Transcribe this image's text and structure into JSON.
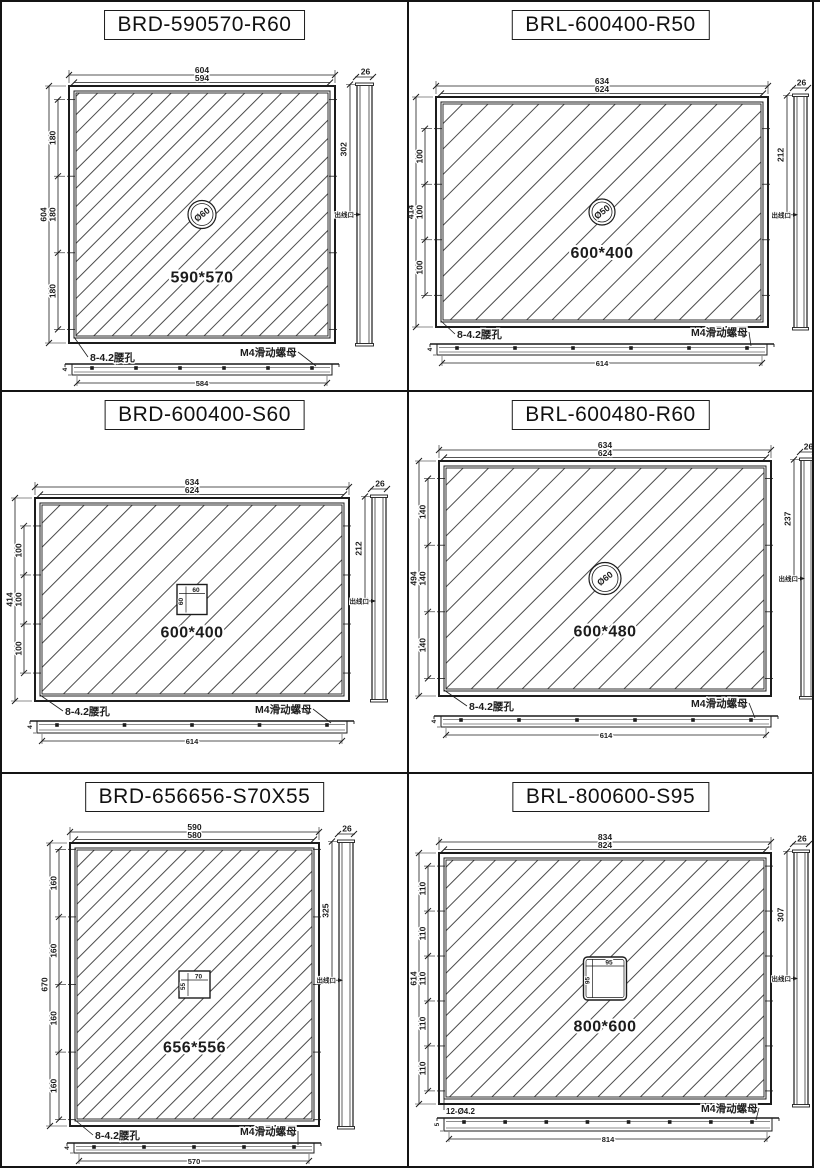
{
  "sheet": {
    "background": "#ffffff",
    "line_color": "#1c1c1c"
  },
  "panels": [
    {
      "title": "BRD-590570-R60",
      "front_view": {
        "outer_width": "604",
        "inner_width": "594",
        "overall_height": "604",
        "height_segments": [
          "180",
          "180",
          "180"
        ],
        "size_label": "590*570",
        "cutout": {
          "type": "circle",
          "label": "Ø60"
        },
        "hole_label": "8-4.2腰孔"
      },
      "side_view": {
        "width": "26",
        "outlet_height": "302",
        "outlet_label": "出线口"
      },
      "bottom_view": {
        "length": "584",
        "height": "4",
        "nut_label": "M4滑动螺母"
      }
    },
    {
      "title": "BRL-600400-R50",
      "front_view": {
        "outer_width": "634",
        "inner_width": "624",
        "overall_height": "414",
        "height_segments": [
          "100",
          "100",
          "100"
        ],
        "size_label": "600*400",
        "cutout": {
          "type": "circle",
          "label": "Ø50"
        },
        "hole_label": "8-4.2腰孔"
      },
      "side_view": {
        "width": "26",
        "outlet_height": "212",
        "outlet_label": "出线口"
      },
      "bottom_view": {
        "length": "614",
        "height": "4",
        "nut_label": "M4滑动螺母"
      }
    },
    {
      "title": "BRD-600400-S60",
      "front_view": {
        "outer_width": "634",
        "inner_width": "624",
        "overall_height": "414",
        "height_segments": [
          "100",
          "100",
          "100"
        ],
        "size_label": "600*400",
        "cutout": {
          "type": "square",
          "width_label": "60",
          "height_label": "60"
        },
        "hole_label": "8-4.2腰孔"
      },
      "side_view": {
        "width": "26",
        "outlet_height": "212",
        "outlet_label": "出线口"
      },
      "bottom_view": {
        "length": "614",
        "height": "4",
        "nut_label": "M4滑动螺母"
      }
    },
    {
      "title": "BRL-600480-R60",
      "front_view": {
        "outer_width": "634",
        "inner_width": "624",
        "overall_height": "494",
        "height_segments": [
          "140",
          "140",
          "140"
        ],
        "size_label": "600*480",
        "cutout": {
          "type": "circle",
          "label": "Ø60"
        },
        "hole_label": "8-4.2腰孔"
      },
      "side_view": {
        "width": "26",
        "outlet_height": "237",
        "outlet_label": "出线口"
      },
      "bottom_view": {
        "length": "614",
        "height": "4",
        "nut_label": "M4滑动螺母"
      }
    },
    {
      "title": "BRD-656656-S70X55",
      "front_view": {
        "outer_width": "590",
        "inner_width": "580",
        "overall_height": "670",
        "height_segments": [
          "160",
          "160",
          "160",
          "160"
        ],
        "size_label": "656*556",
        "cutout": {
          "type": "rect",
          "width_label": "70",
          "height_label": "55"
        },
        "hole_label": "8-4.2腰孔"
      },
      "side_view": {
        "width": "26",
        "outlet_height": "325",
        "outlet_label": "出线口"
      },
      "bottom_view": {
        "length": "570",
        "height": "4",
        "nut_label": "M4滑动螺母"
      }
    },
    {
      "title": "BRL-800600-S95",
      "front_view": {
        "outer_width": "834",
        "inner_width": "824",
        "overall_height": "614",
        "height_segments": [
          "110",
          "110",
          "110",
          "110",
          "110"
        ],
        "size_label": "800*600",
        "cutout": {
          "type": "rect",
          "width_label": "95",
          "height_label": "95"
        },
        "hole_label": "12-Ø4.2"
      },
      "side_view": {
        "width": "26",
        "outlet_height": "307",
        "outlet_label": "出线口"
      },
      "bottom_view": {
        "length": "814",
        "height": "5",
        "nut_label": "M4滑动螺母"
      }
    }
  ],
  "layout": {
    "cells": [
      [
        2,
        2,
        405,
        388
      ],
      [
        409,
        2,
        403,
        388
      ],
      [
        2,
        392,
        405,
        380
      ],
      [
        409,
        392,
        403,
        380
      ],
      [
        2,
        774,
        405,
        392
      ],
      [
        409,
        774,
        403,
        392
      ]
    ],
    "panels": [
      {
        "front": {
          "x": 67,
          "y": 84,
          "w": 266,
          "h": 257
        },
        "hatch": 13,
        "side": {
          "x": 355,
          "y": 82,
          "w": 15,
          "h": 261,
          "frac": 0.5
        },
        "strip": {
          "x": 70,
          "y": 362,
          "w": 260,
          "h": 11,
          "dots": 6
        },
        "feature": {
          "r": 14
        },
        "size_dy": 68,
        "hole": {
          "x": 88,
          "y": 359
        },
        "nut": {
          "x": 238,
          "y": 354,
          "lw": 58
        }
      },
      {
        "front": {
          "x": 27,
          "y": 95,
          "w": 332,
          "h": 230
        },
        "hatch": 18,
        "side": {
          "x": 385,
          "y": 93,
          "w": 13,
          "h": 234,
          "frac": 0.512
        },
        "strip": {
          "x": 28,
          "y": 342,
          "w": 330,
          "h": 11,
          "dots": 6
        },
        "feature": {
          "r": 13
        },
        "size_dy": 46,
        "hole": {
          "x": 48,
          "y": 336
        },
        "nut": {
          "x": 282,
          "y": 334,
          "lw": 58
        }
      },
      {
        "front": {
          "x": 33,
          "y": 106,
          "w": 314,
          "h": 203
        },
        "hatch": 17,
        "side": {
          "x": 370,
          "y": 104,
          "w": 14,
          "h": 205,
          "frac": 0.512
        },
        "strip": {
          "x": 35,
          "y": 329,
          "w": 310,
          "h": 12,
          "dots": 5
        },
        "feature": {
          "w": 30,
          "h": 30
        },
        "size_dy": 38,
        "hole": {
          "x": 63,
          "y": 323
        },
        "nut": {
          "x": 253,
          "y": 321,
          "lw": 58
        }
      },
      {
        "front": {
          "x": 30,
          "y": 69,
          "w": 332,
          "h": 235
        },
        "hatch": 18,
        "side": {
          "x": 392,
          "y": 67,
          "w": 13,
          "h": 239,
          "frac": 0.5
        },
        "strip": {
          "x": 32,
          "y": 324,
          "w": 330,
          "h": 11,
          "dots": 6
        },
        "feature": {
          "r": 16
        },
        "size_dy": 58,
        "hole": {
          "x": 60,
          "y": 318
        },
        "nut": {
          "x": 282,
          "y": 315,
          "lw": 58
        }
      },
      {
        "front": {
          "x": 68,
          "y": 69,
          "w": 249,
          "h": 283
        },
        "hatch": 13,
        "side": {
          "x": 337,
          "y": 67,
          "w": 14,
          "h": 287,
          "frac": 0.485
        },
        "strip": {
          "x": 72,
          "y": 369,
          "w": 240,
          "h": 10,
          "dots": 5
        },
        "feature": {
          "w": 31,
          "h": 27
        },
        "size_dy": 68,
        "hole": {
          "x": 93,
          "y": 365
        },
        "nut": {
          "x": 238,
          "y": 361,
          "lw": 58
        }
      },
      {
        "front": {
          "x": 30,
          "y": 79,
          "w": 332,
          "h": 251
        },
        "hatch": 15,
        "side": {
          "x": 385,
          "y": 77,
          "w": 14,
          "h": 255,
          "frac": 0.5
        },
        "strip": {
          "x": 35,
          "y": 344,
          "w": 328,
          "h": 13,
          "dots": 8
        },
        "feature": {
          "w": 43,
          "h": 43,
          "rounded": true
        },
        "size_dy": 53,
        "hole": {
          "x": 37,
          "y": 340,
          "small": true
        },
        "nut": {
          "x": 292,
          "y": 338,
          "lw": 58
        }
      }
    ]
  }
}
